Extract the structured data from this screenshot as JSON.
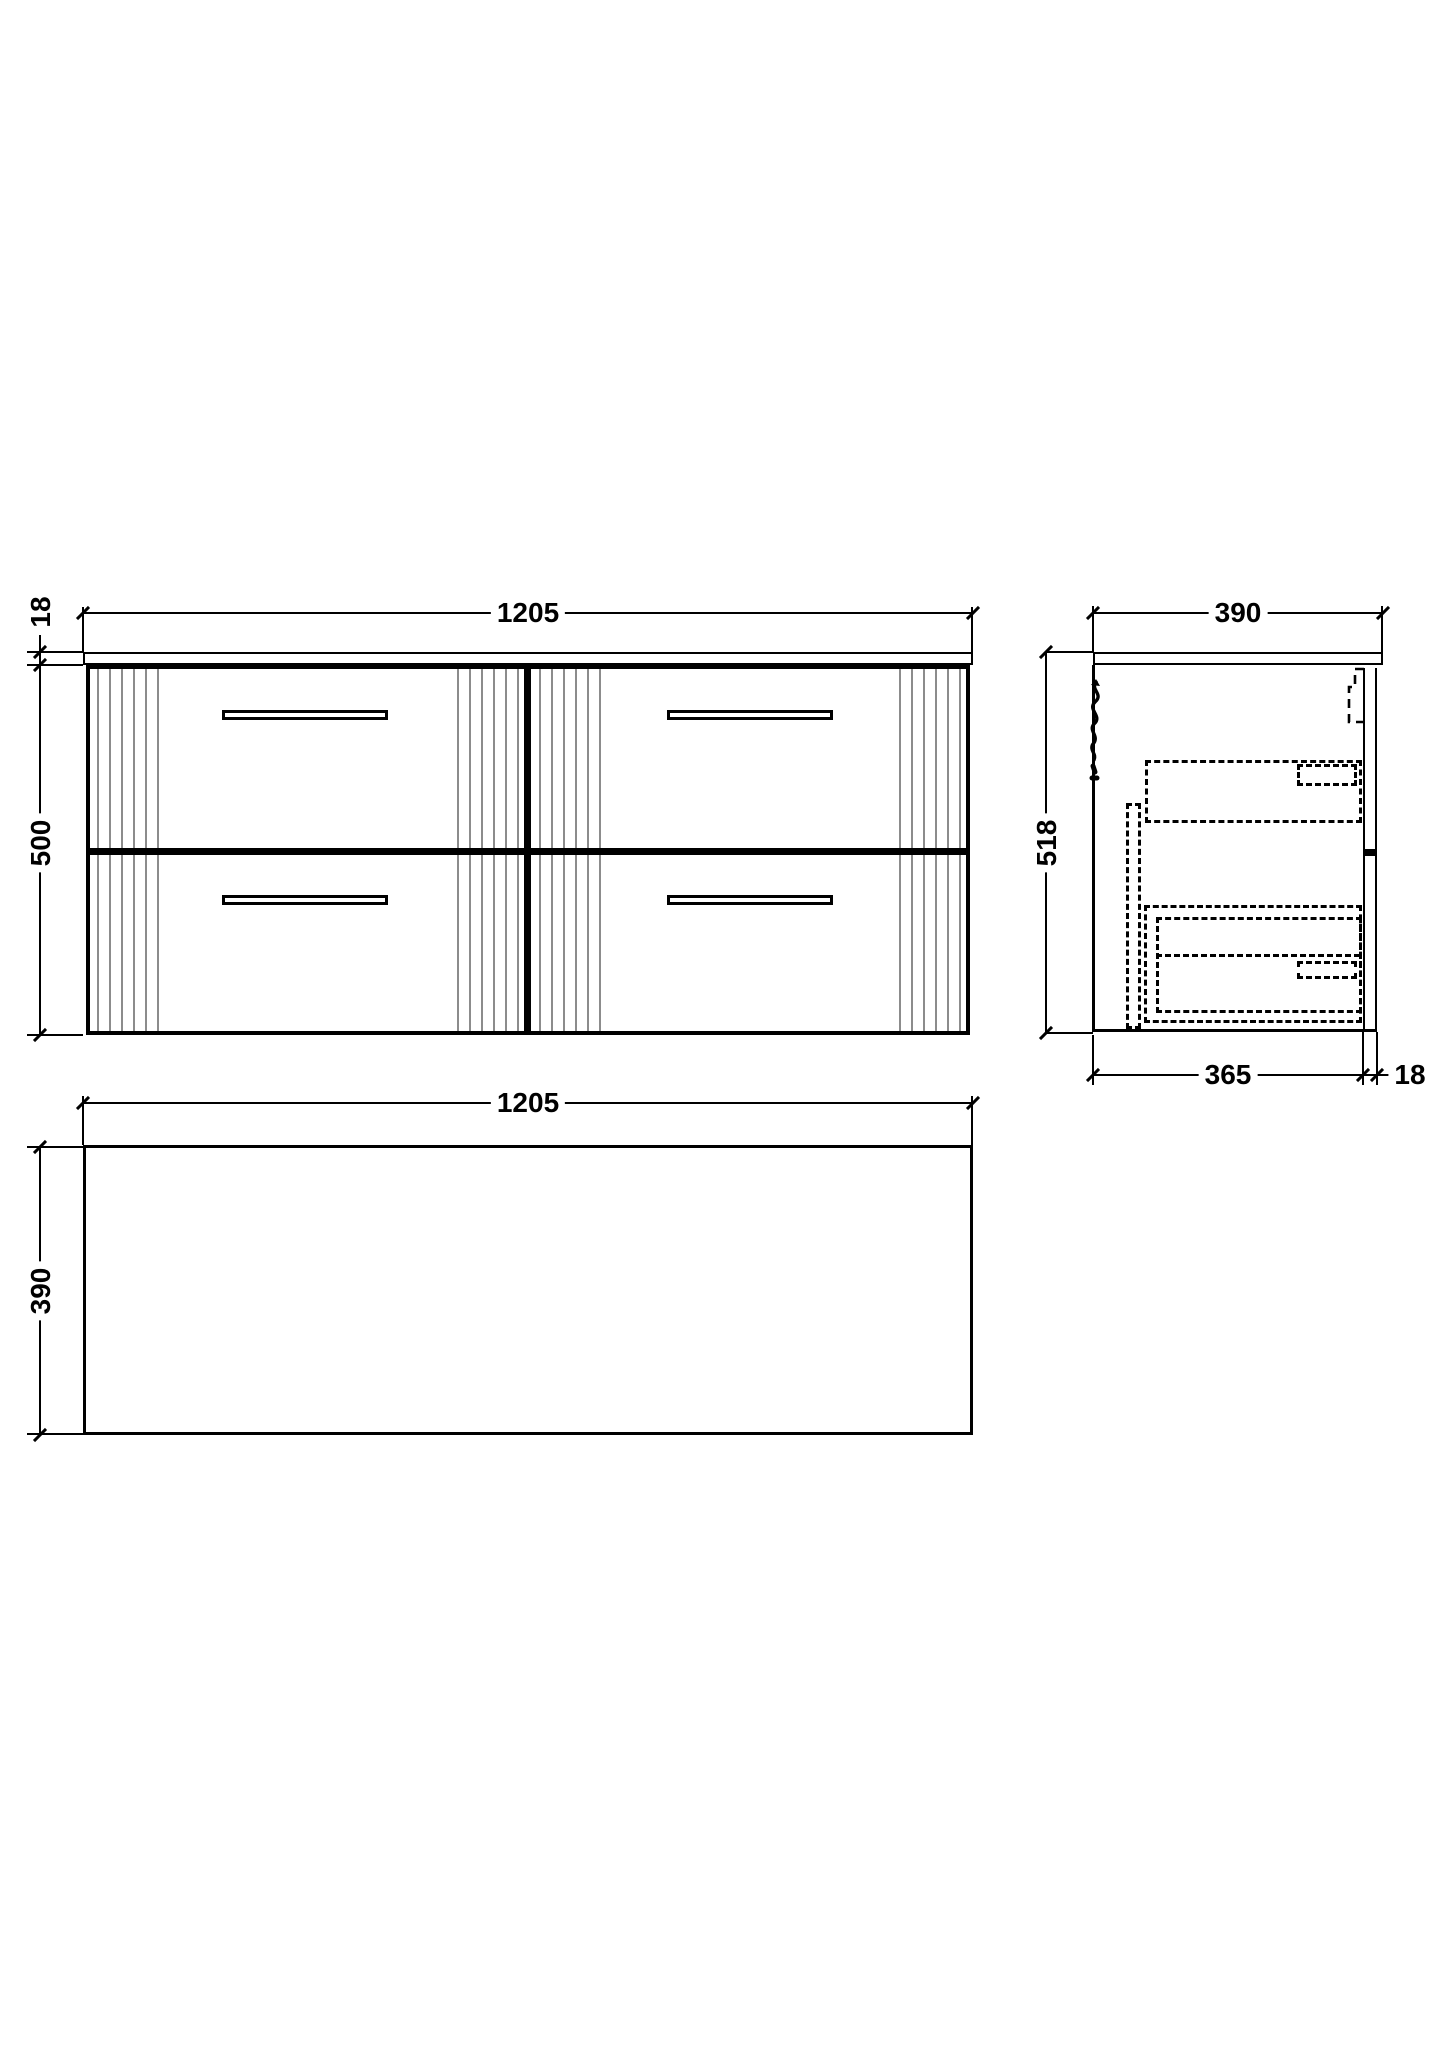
{
  "views": {
    "front": {
      "width": "1205",
      "worktop_thickness": "18",
      "cabinet_height": "500"
    },
    "side": {
      "depth": "390",
      "overall_height": "518",
      "cabinet_depth": "365",
      "back_panel_thickness": "18"
    },
    "plan": {
      "width": "1205",
      "depth": "390"
    }
  },
  "colors": {
    "line": "#000000",
    "flute_line": "#8c8c8c",
    "background": "#ffffff"
  }
}
